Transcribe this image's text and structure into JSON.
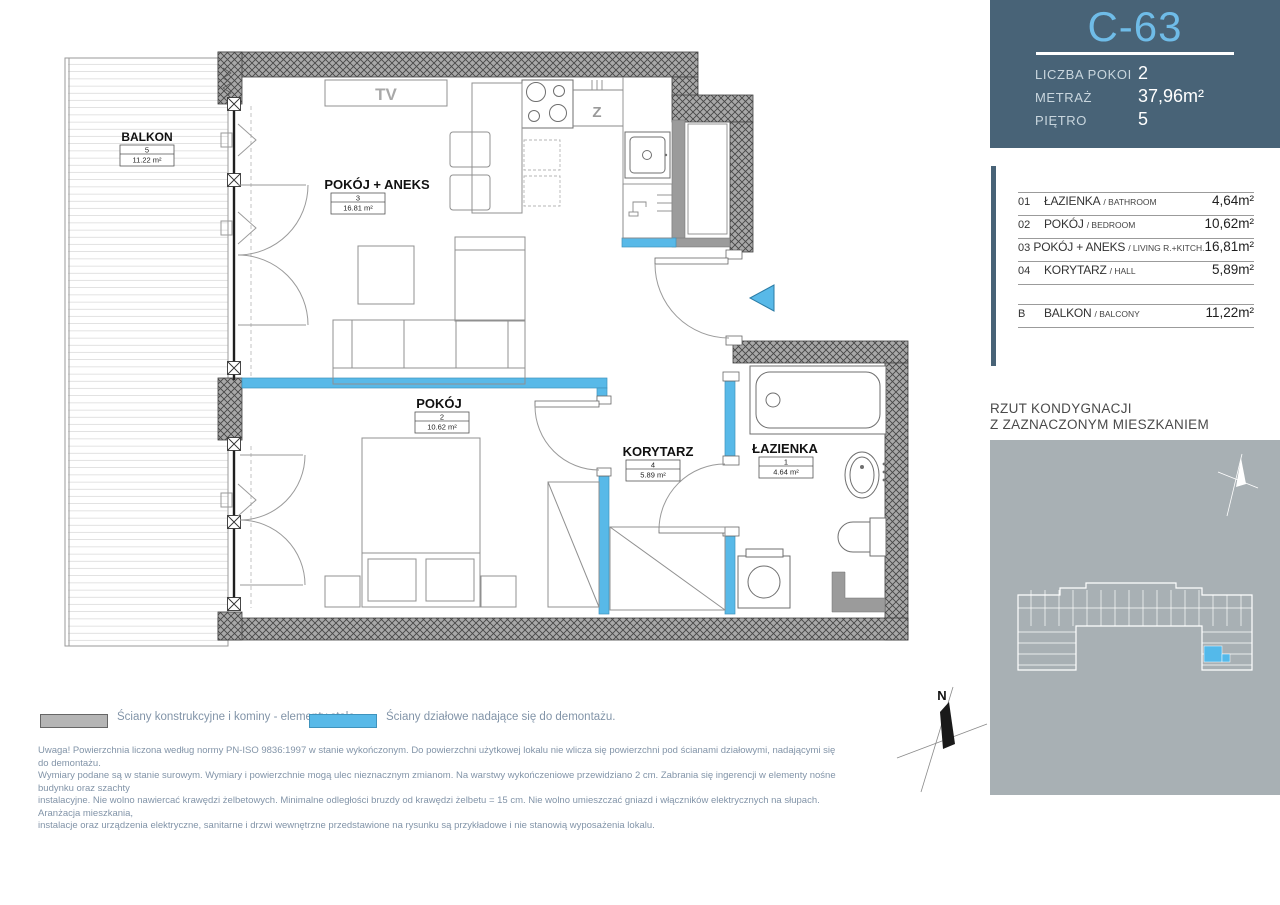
{
  "unit_card": {
    "id": "C-63",
    "rows": [
      {
        "label": "LICZBA POKOI",
        "value": "2"
      },
      {
        "label": "METRAŻ",
        "value": "37,96m²"
      },
      {
        "label": "PIĘTRO",
        "value": "5"
      }
    ]
  },
  "room_table": {
    "rooms": [
      {
        "num": "01",
        "name": "ŁAZIENKA",
        "name_en": "/ BATHROOM",
        "area": "4,64m²"
      },
      {
        "num": "02",
        "name": "POKÓJ",
        "name_en": "/ BEDROOM",
        "area": "10,62m²"
      },
      {
        "num": "03",
        "name": "POKÓJ + ANEKS",
        "name_en": "/ LIVING R.+KITCH.",
        "area": "16,81m²"
      },
      {
        "num": "04",
        "name": "KORYTARZ",
        "name_en": "/ HALL",
        "area": "5,89m²"
      }
    ],
    "balcony": {
      "num": "B",
      "name": "BALKON",
      "name_en": "/ BALCONY",
      "area": "11,22m²"
    }
  },
  "floor_overview": {
    "title_line1": "RZUT KONDYGNACJI",
    "title_line2": "Z ZAZNACZONYM MIESZKANIEM"
  },
  "plan": {
    "balcony": {
      "name": "BALKON",
      "num": "5",
      "area": "11.22 m²"
    },
    "living": {
      "name": "POKÓJ + ANEKS",
      "num": "3",
      "area": "16.81 m²"
    },
    "bedroom": {
      "name": "POKÓJ",
      "num": "2",
      "area": "10.62 m²"
    },
    "hall": {
      "name": "KORYTARZ",
      "num": "4",
      "area": "5.89 m²"
    },
    "bathroom": {
      "name": "ŁAZIENKA",
      "num": "1",
      "area": "4.64 m²"
    },
    "tv_label": "TV",
    "sink_label": "Z"
  },
  "compass": {
    "north_label": "N"
  },
  "legend": {
    "structural": "Ściany konstrukcyjne i kominy - elementy stałe.",
    "partition": "Ściany działowe nadające się do demontażu."
  },
  "disclaimer_lines": [
    "Uwaga! Powierzchnia liczona według normy PN-ISO 9836:1997 w stanie wykończonym. Do powierzchni użytkowej lokalu nie wlicza się powierzchni pod ścianami działowymi, nadającymi się do demontażu.",
    "Wymiary podane są w stanie surowym. Wymiary i powierzchnie mogą ulec nieznacznym zmianom. Na warstwy wykończeniowe przewidziano 2 cm. Zabrania się ingerencji w elementy nośne budynku oraz szachty",
    "instalacyjne. Nie wolno nawiercać krawędzi żelbetowych. Minimalne odległości bruzdy od krawędzi żelbetu = 15 cm. Nie wolno umieszczać gniazd i włączników elektrycznych na słupach. Aranżacja mieszkania,",
    "instalacje oraz urządzenia elektryczne, sanitarne i drzwi wewnętrzne przedstawione na rysunku są przykładowe i nie stanowią wyposażenia lokalu."
  ],
  "colors": {
    "panel_slate": "#486377",
    "unit_id_blue": "#6fbce8",
    "partition_blue": "#58b9e8",
    "minimap_gray": "#a8b0b4",
    "highlight_blue": "#54b9ea"
  }
}
